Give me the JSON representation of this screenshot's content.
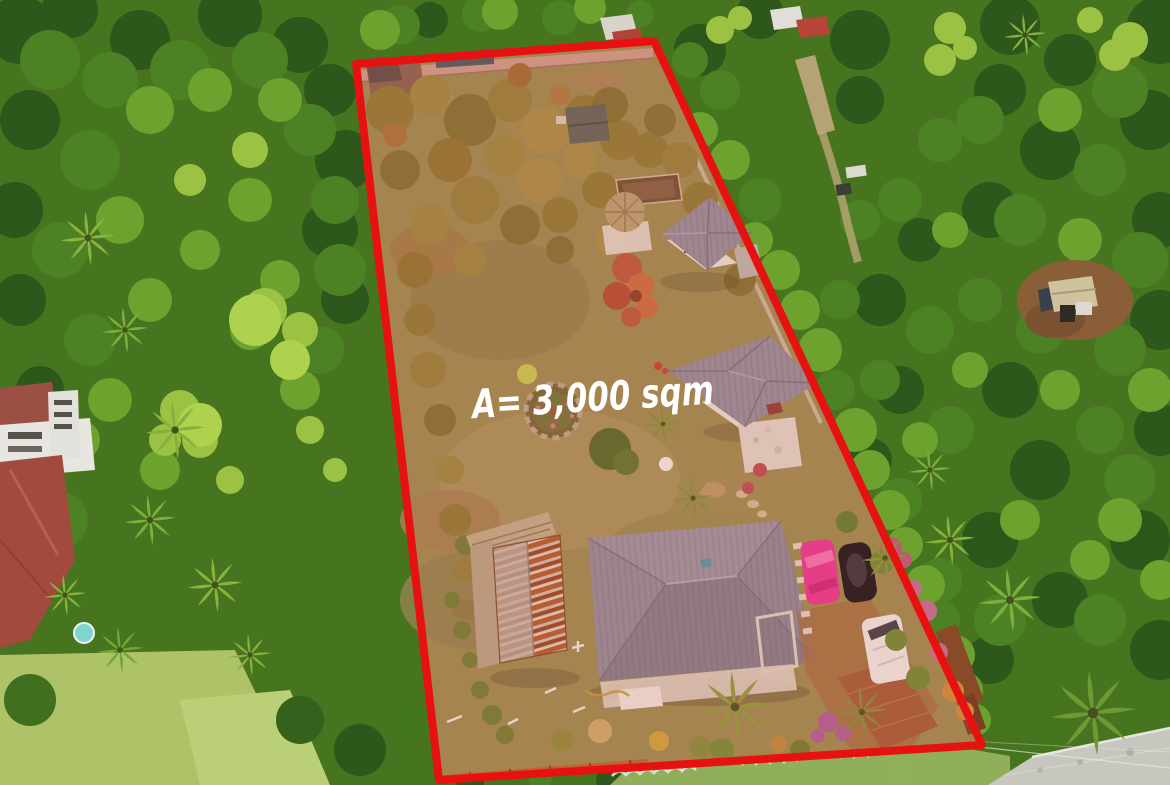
{
  "photo": {
    "area_label": "A= 3,000 sqm",
    "boundary_color": "#e81111",
    "label_color": "#ffffff",
    "scene": {
      "type": "aerial drone photo",
      "subject": "residential lot for sale outlined in red, area 3,000 sqm",
      "vehicles": [
        "pink car",
        "black car",
        "white van"
      ],
      "structures_inside": [
        "perimeter wall",
        "guest house",
        "nipa hut",
        "middle house",
        "main house with gray hip roof",
        "rusty corrugated shed",
        "stone garden circle"
      ],
      "surroundings": [
        "dense tropical trees",
        "coconut palms",
        "red-roofed neighbor houses",
        "small hut on dirt clearing",
        "concrete road at bottom right"
      ]
    }
  }
}
